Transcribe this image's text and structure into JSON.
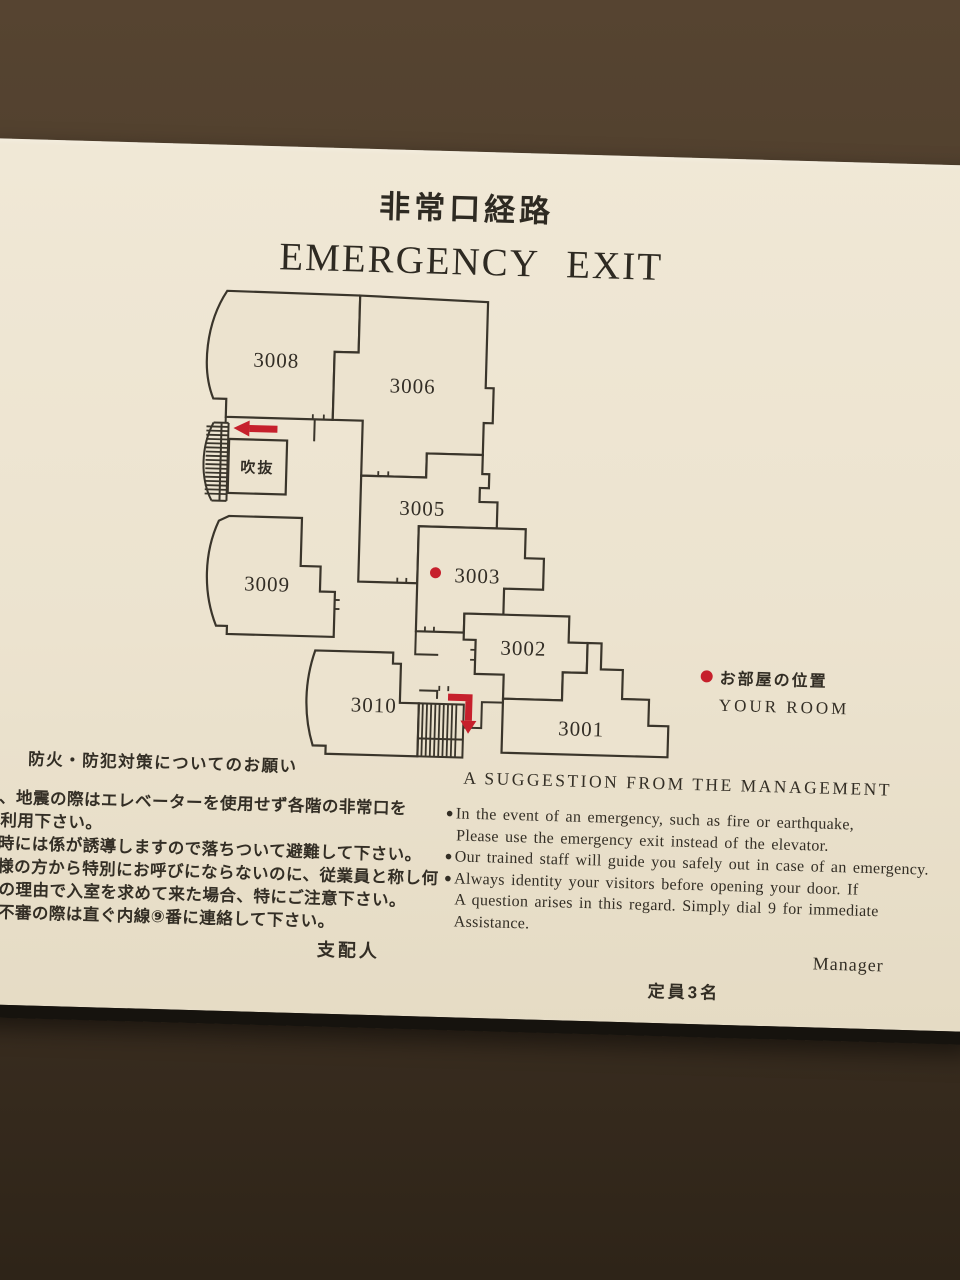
{
  "sign": {
    "title_jp": "非常口経路",
    "title_en": "EMERGENCY EXIT",
    "plan": {
      "rooms": [
        {
          "label": "3008",
          "x": 75,
          "y": 78
        },
        {
          "label": "3006",
          "x": 212,
          "y": 100
        },
        {
          "label": "3005",
          "x": 225,
          "y": 222
        },
        {
          "label": "3003",
          "x": 282,
          "y": 288
        },
        {
          "label": "3002",
          "x": 330,
          "y": 359
        },
        {
          "label": "3001",
          "x": 390,
          "y": 438
        },
        {
          "label": "3010",
          "x": 182,
          "y": 420
        },
        {
          "label": "3009",
          "x": 72,
          "y": 302
        },
        {
          "label": "吹抜",
          "x": 59,
          "y": 187,
          "small": true
        }
      ],
      "marker": {
        "room": "3003",
        "x": 240,
        "y": 286
      },
      "legend_jp": "お部屋の位置",
      "legend_en": "YOUR ROOM",
      "accent_red": "#c6202c",
      "line_color": "#3a352b"
    },
    "jp_notice": {
      "heading": "防火・防犯対策についてのお願い",
      "lines": [
        "災、地震の際はエレベーターを使用せず各階の非常口を",
        "利用下さい。",
        "常時には係が誘導しますので落ちついて避難して下さい。",
        "客様の方から特別にお呼びにならないのに、従業員と称し何",
        "の理由で入室を求めて来た場合、特にご注意下さい。",
        "不審の際は直ぐ内線⑨番に連絡して下さい。"
      ],
      "signoff": "支配人"
    },
    "en_notice": {
      "heading": "A SUGGESTION FROM THE MANAGEMENT",
      "bullet_char": "●",
      "lines": [
        {
          "bullet": true,
          "text": "In the event of an emergency, such as fire or earthquake,"
        },
        {
          "bullet": false,
          "text": "Please use the emergency exit instead of the elevator."
        },
        {
          "bullet": true,
          "text": "Our trained staff will guide you safely out in case of an emergency."
        },
        {
          "bullet": true,
          "text": "Always identity your visitors before opening your door. If"
        },
        {
          "bullet": false,
          "text": "A question arises in this regard. Simply dial 9 for immediate"
        },
        {
          "bullet": false,
          "text": "Assistance."
        }
      ],
      "signoff": "Manager"
    },
    "capacity": "定員3名"
  }
}
